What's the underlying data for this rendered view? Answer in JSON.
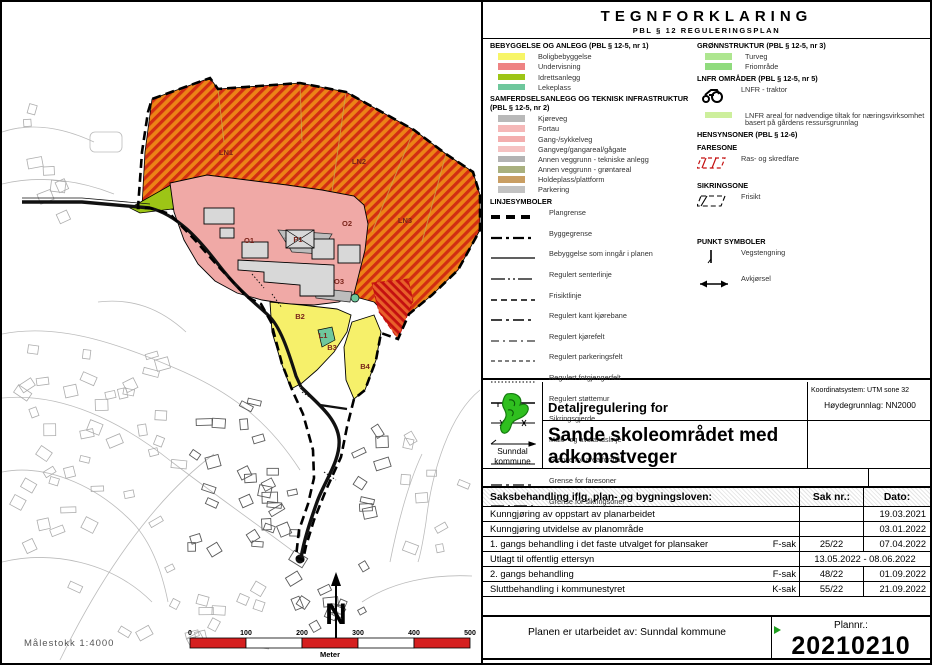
{
  "legend": {
    "title": "TEGNFORKLARING",
    "subtitle": "PBL § 12 REGULERINGSPLAN",
    "left_sections": [
      {
        "heading": "BEBYGGELSE OG ANLEGG (PBL § 12-5, nr 1)",
        "items": [
          {
            "label": "Boligbebyggelse",
            "chip": "#F7F567"
          },
          {
            "label": "Undervisning",
            "chip": "#EE8383"
          },
          {
            "label": "Idrettsanlegg",
            "chip": "#9DC516"
          },
          {
            "label": "Lekeplass",
            "chip": "#6EC79C"
          }
        ]
      },
      {
        "heading": "SAMFERDSELSANLEGG OG TEKNISK INFRASTRUKTUR (PBL § 12-5, nr 2)",
        "items": [
          {
            "label": "Kjøreveg",
            "chip": "#B9B9B9"
          },
          {
            "label": "Fortau",
            "chip": "#F5B8B8"
          },
          {
            "label": "Gang-/sykkelveg",
            "chip": "#F3AEAE"
          },
          {
            "label": "Gangveg/gangareal/gågate",
            "chip": "#F5C2C2"
          },
          {
            "label": "Annen veggrunn - tekniske anlegg",
            "chip": "#B3B3B3"
          },
          {
            "label": "Annen veggrunn - grøntareal",
            "chip": "#A9B07E"
          },
          {
            "label": "Holdeplass/plattform",
            "chip": "#C99E63"
          },
          {
            "label": "Parkering",
            "chip": "#C2C2C2"
          }
        ]
      },
      {
        "heading": "LINJESYMBOLER",
        "items": [
          {
            "label": "Plangrense",
            "line": "plangrense"
          },
          {
            "label": "Byggegrense",
            "line": "byggegrense"
          },
          {
            "label": "Bebyggelse som inngår i planen",
            "line": "bebyggelse_plan"
          },
          {
            "label": "Regulert senterlinje",
            "line": "senterlinje"
          },
          {
            "label": "Frisiktlinje",
            "line": "frisiktlinje"
          },
          {
            "label": "Regulert kant kjørebane",
            "line": "kant_kjorebane"
          },
          {
            "label": "Regulert kjørefelt",
            "line": "kjorefelt"
          },
          {
            "label": "Regulert parkeringsfelt",
            "line": "parkeringsfelt"
          },
          {
            "label": "Regulert fotgjengerfelt",
            "line": "fotgjengerfelt"
          },
          {
            "label": "Regulert støttemur",
            "line": "stottemur"
          },
          {
            "label": "Sikringsgjerde",
            "line": "sikringsgjerde"
          },
          {
            "label": "Måle- og avstandslinje",
            "line": "male_avstand"
          },
          {
            "label": "Grense for arealformål",
            "line": "grense_arealformal"
          },
          {
            "label": "Grense for faresoner",
            "line": "grense_faresoner"
          },
          {
            "label": "Grense for sikringsoner",
            "line": "grense_sikringsoner"
          }
        ]
      }
    ],
    "right_sections": [
      {
        "heading": "GRØNNSTRUKTUR (PBL § 12-5, nr 3)",
        "items": [
          {
            "label": "Turveg",
            "chip": "#AEE690"
          },
          {
            "label": "Friområde",
            "chip": "#90DB7E"
          }
        ]
      },
      {
        "heading": "LNFR OMRÅDER (PBL § 12-5, nr 5)",
        "items": [
          {
            "label": "LNFR - traktor",
            "symbol": "tractor"
          },
          {
            "label": "LNFR areal for nødvendige tiltak for næringsvirksomhet basert på gårdens ressursgrunnlag",
            "chip": "#CDEF9C"
          }
        ]
      },
      {
        "heading": "HENSYNSONER (PBL § 12-6)",
        "items": []
      },
      {
        "heading": "FARESONE",
        "items": [
          {
            "label": "Ras- og skredfare",
            "symbol": "faresone"
          }
        ]
      },
      {
        "heading": "SIKRINGSONE",
        "items": [
          {
            "label": "Frisikt",
            "symbol": "frisikt"
          }
        ]
      },
      {
        "heading": "PUNKT SYMBOLER",
        "gap_before": 22,
        "items": [
          {
            "label": "Vegstengning",
            "symbol": "vegstengning"
          },
          {
            "label": "Avkjørsel",
            "symbol": "avkjorsel"
          }
        ]
      }
    ]
  },
  "title_block": {
    "logo_text_line1": "Sunndal",
    "logo_text_line2": "kommune",
    "coord_system": "Koordinatsystem: UTM sone 32",
    "height_datum": "Høydegrunnlag: NN2000",
    "plan_type": "Detaljregulering for",
    "plan_title": "Sande skoleområdet med adkomstveger"
  },
  "case_table": {
    "header": {
      "col1": "Saksbehandling iflg. plan- og bygningsloven:",
      "col2": "Sak nr.:",
      "col3": "Dato:"
    },
    "rows": [
      {
        "desc": "Kunngjøring av oppstart av planarbeidet",
        "case_type": "",
        "sak": "",
        "dato": "19.03.2021"
      },
      {
        "desc": "Kunngjøring utvidelse av planområde",
        "case_type": "",
        "sak": "",
        "dato": "03.01.2022"
      },
      {
        "desc": "1. gangs behandling i det faste utvalget for plansaker",
        "case_type": "F-sak",
        "sak": "25/22",
        "dato": "07.04.2022"
      },
      {
        "desc": "Utlagt til offentlig ettersyn",
        "case_type": "",
        "merged": "13.05.2022 - 08.06.2022"
      },
      {
        "desc": "2. gangs behandling",
        "case_type": "F-sak",
        "sak": "48/22",
        "dato": "01.09.2022"
      },
      {
        "desc": "Sluttbehandling i kommunestyret",
        "case_type": "K-sak",
        "sak": "55/22",
        "dato": "21.09.2022"
      }
    ]
  },
  "footer": {
    "prepared_by": "Planen er utarbeidet av: Sunndal kommune",
    "plannr_label": "Plannr.:",
    "plannr": "20210210"
  },
  "map": {
    "scale_text": "Målestokk 1:4000",
    "north_label": "N",
    "scale_bar": {
      "ticks": [
        "0",
        "100",
        "200",
        "300",
        "400",
        "500"
      ],
      "unit": "Meter"
    },
    "area_labels": [
      {
        "text": "LN1",
        "x": 224,
        "y": 153
      },
      {
        "text": "LN2",
        "x": 357,
        "y": 162
      },
      {
        "text": "LN3",
        "x": 403,
        "y": 221
      },
      {
        "text": "O1",
        "x": 247,
        "y": 241
      },
      {
        "text": "O2",
        "x": 345,
        "y": 224
      },
      {
        "text": "O3",
        "x": 337,
        "y": 282
      },
      {
        "text": "P1",
        "x": 296,
        "y": 240
      },
      {
        "text": "B2",
        "x": 298,
        "y": 317
      },
      {
        "text": "B3",
        "x": 330,
        "y": 348
      },
      {
        "text": "B4",
        "x": 363,
        "y": 367
      },
      {
        "text": "L1",
        "x": 321,
        "y": 336
      }
    ]
  },
  "colors": {
    "plan_yellow": "#F6F06A",
    "plan_pink": "#F0A9A6",
    "plan_green": "#9DC516",
    "plan_teal": "#6EC79C",
    "hatch_base": "#EC8316",
    "hatch_stripe": "#D22D12",
    "fare_base": "#E8602A",
    "fare_stripe": "#C41010",
    "road_dark": "#111111",
    "gray_area": "#BDBDBD",
    "building": "#D8D8D8",
    "scalebar_red": "#D51F1F",
    "logo_green": "#2FBF1F",
    "label_red": "#7A241A"
  }
}
